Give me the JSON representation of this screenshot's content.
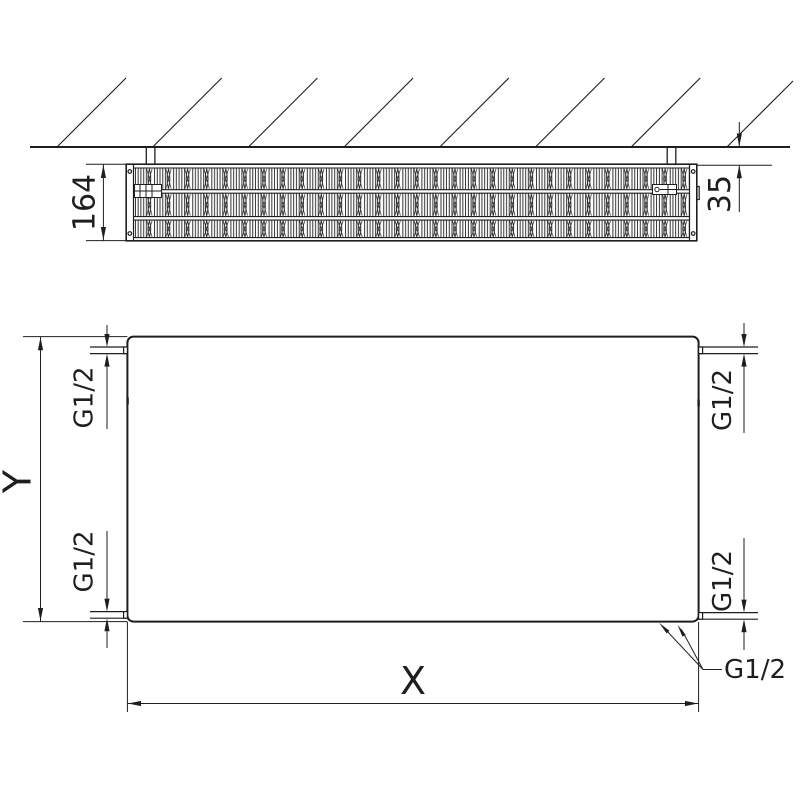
{
  "drawing": {
    "background": "#ffffff",
    "line_color": "#1e1e1e",
    "top_view": {
      "depth_dimension": "164",
      "wall_clearance_dimension": "35"
    },
    "front_view": {
      "width_dimension": "X",
      "height_dimension": "Y",
      "thread_top_left": "G1/2",
      "thread_bottom_left": "G1/2",
      "thread_top_right": "G1/2",
      "thread_bottom_right": "G1/2",
      "thread_bottom_leader": "G1/2"
    }
  }
}
